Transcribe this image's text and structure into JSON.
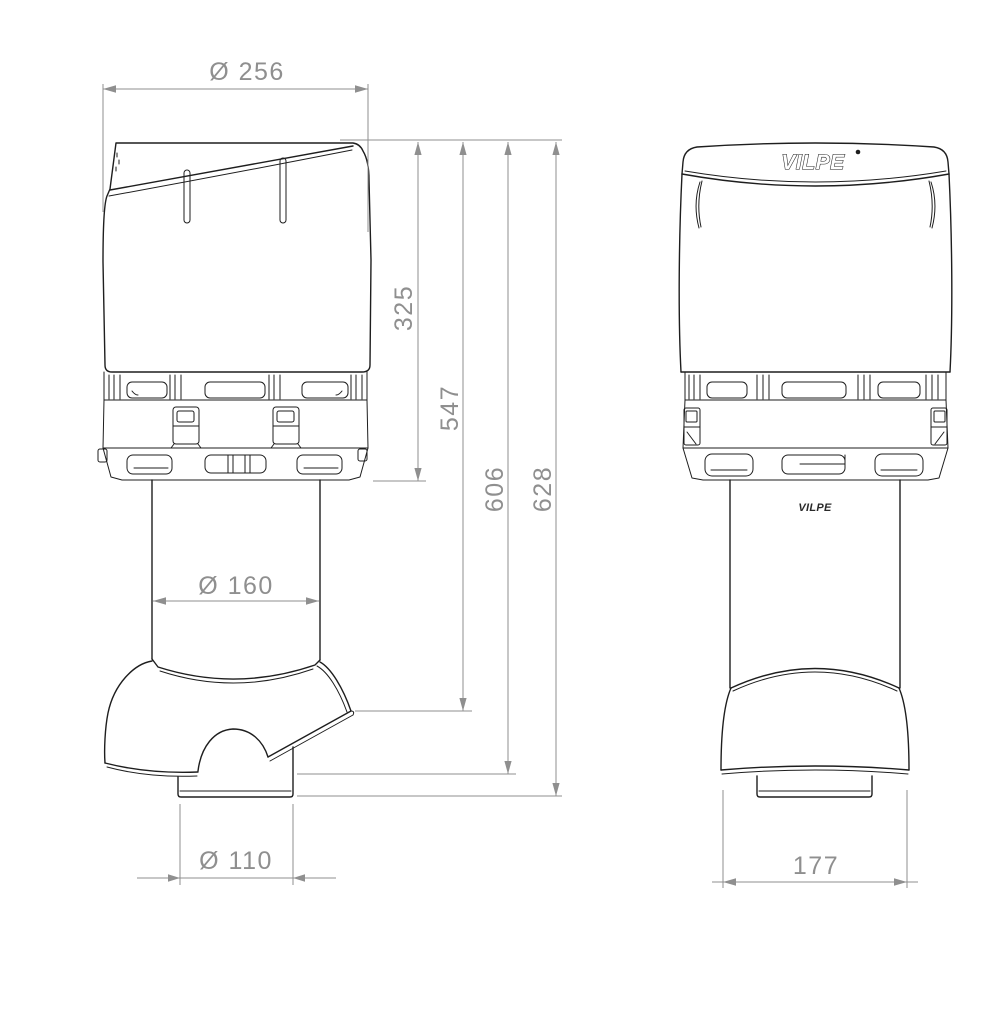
{
  "drawing": {
    "brand_logo": "VILPE",
    "pipe_logo": "VILPE",
    "dimensions": {
      "top_diameter": "Ø 256",
      "hood_height": "325",
      "height_to_collar_edge": "547",
      "height_to_skirt": "606",
      "total_height": "628",
      "pipe_diameter": "Ø 160",
      "outlet_diameter": "Ø 110",
      "collar_width": "177"
    },
    "colors": {
      "outline": "#1e1e1e",
      "dimension": "#8f8f8f",
      "background": "#ffffff"
    }
  }
}
